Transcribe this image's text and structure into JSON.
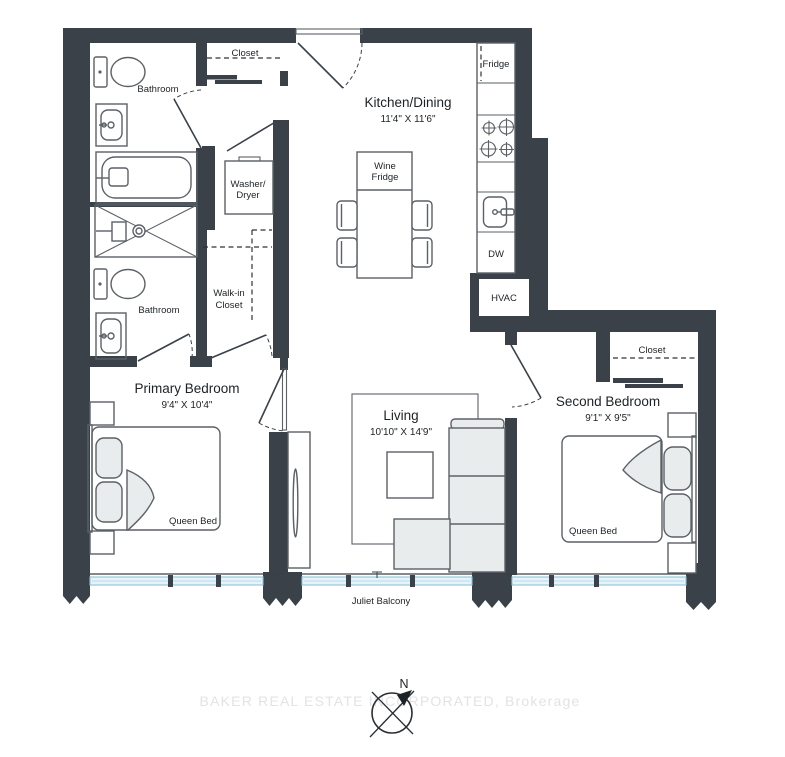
{
  "labels": {
    "bathroom_top": "Bathroom",
    "closet_top": "Closet",
    "kitchen_title": "Kitchen/Dining",
    "kitchen_dims": "11'4\" X 11'6\"",
    "fridge": "Fridge",
    "wine_fridge_1": "Wine",
    "wine_fridge_2": "Fridge",
    "washer_1": "Washer/",
    "washer_2": "Dryer",
    "walkin_1": "Walk-in",
    "walkin_2": "Closet",
    "bathroom_lower": "Bathroom",
    "dw": "DW",
    "hvac": "HVAC",
    "primary_title": "Primary Bedroom",
    "primary_dims": "9'4\" X 10'4\"",
    "primary_bed": "Queen Bed",
    "living_title": "Living",
    "living_dims": "10'10\" X 14'9\"",
    "second_title": "Second Bedroom",
    "second_dims": "9'1\" X 9'5\"",
    "second_closet": "Closet",
    "second_bed": "Queen Bed",
    "balcony": "Juliet Balcony",
    "compass_north": "N",
    "watermark": "BAKER REAL ESTATE INCORPORATED, Brokerage"
  },
  "colors": {
    "wall": "#3a4149",
    "window_accent": "#8cc4d8",
    "furniture_fill": "#e9ecec",
    "text": "#1d2226",
    "watermark": "#e3e3e3"
  }
}
